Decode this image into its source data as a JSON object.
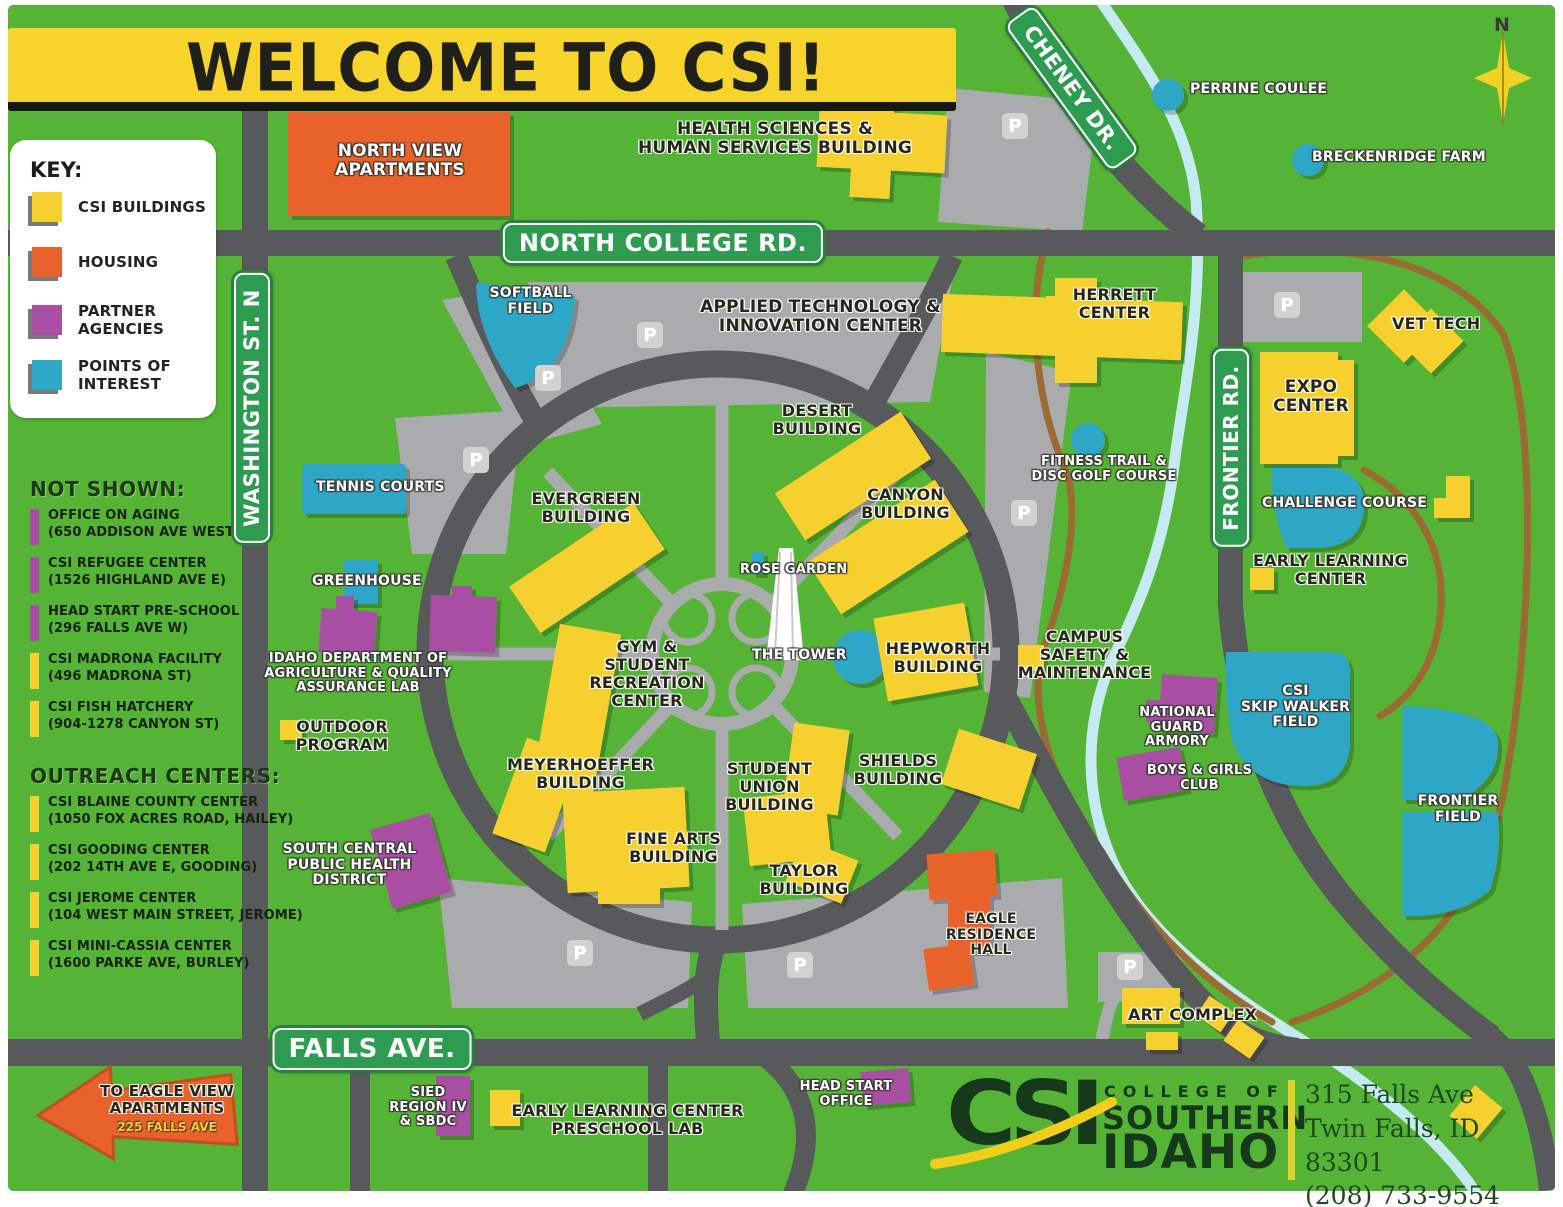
{
  "title": "WELCOME TO CSI!",
  "compass_n": "N",
  "parking_label": "P",
  "colors": {
    "map_green": "#55B335",
    "road_gray": "#58595B",
    "parking_gray": "#A9ABAD",
    "building_yellow": "#F5D02F",
    "housing_orange": "#E8632C",
    "partner_purple": "#A84FA3",
    "interest_teal": "#2FA7C6",
    "sign_green": "#2D9C50",
    "banner_yellow": "#F7D42C",
    "creek_blue": "#C5EAF2",
    "trail_brown": "#9B6B33"
  },
  "key": {
    "heading": "KEY:",
    "items": [
      {
        "label": "CSI BUILDINGS",
        "color": "#F5D02F"
      },
      {
        "label": "HOUSING",
        "color": "#E8632C"
      },
      {
        "label": "PARTNER AGENCIES",
        "color": "#A84FA3"
      },
      {
        "label": "POINTS OF INTEREST",
        "color": "#2FA7C6"
      }
    ]
  },
  "not_shown": {
    "heading": "NOT SHOWN:",
    "items": [
      {
        "name": "OFFICE ON AGING",
        "address": "(650 ADDISON AVE WEST)",
        "color": "#A84FA3"
      },
      {
        "name": "CSI REFUGEE CENTER",
        "address": "(1526 HIGHLAND AVE E)",
        "color": "#A84FA3"
      },
      {
        "name": "HEAD START PRE-SCHOOL",
        "address": "(296 FALLS AVE W)",
        "color": "#A84FA3"
      },
      {
        "name": "CSI MADRONA FACILITY",
        "address": "(496 MADRONA ST)",
        "color": "#F5D02F"
      },
      {
        "name": "CSI FISH HATCHERY",
        "address": "(904-1278 CANYON ST)",
        "color": "#F5D02F"
      }
    ]
  },
  "outreach": {
    "heading": "OUTREACH CENTERS:",
    "items": [
      {
        "name": "CSI BLAINE COUNTY CENTER",
        "address": "(1050 FOX ACRES ROAD, HAILEY)",
        "color": "#F5D02F"
      },
      {
        "name": "CSI GOODING CENTER",
        "address": "(202 14TH AVE E, GOODING)",
        "color": "#F5D02F"
      },
      {
        "name": "CSI JEROME CENTER",
        "address": "(104 WEST MAIN STREET, JEROME)",
        "color": "#F5D02F"
      },
      {
        "name": "CSI MINI-CASSIA CENTER",
        "address": "(1600 PARKE AVE, BURLEY)",
        "color": "#F5D02F"
      }
    ]
  },
  "road_signs": {
    "north_college": "NORTH COLLEGE RD.",
    "washington": "WASHINGTON ST. N",
    "cheney": "CHENEY DR.",
    "frontier": "FRONTIER RD.",
    "falls": "FALLS AVE."
  },
  "labels": {
    "north_view": "NORTH VIEW\nAPARTMENTS",
    "health_sciences": "HEALTH SCIENCES &\nHUMAN SERVICES BUILDING",
    "perrine_coulee": "PERRINE COULEE",
    "breckenridge_farm": "BRECKENRIDGE FARM",
    "softball_field": "SOFTBALL\nFIELD",
    "applied_tech": "APPLIED TECHNOLOGY &\nINNOVATION CENTER",
    "herrett_center": "HERRETT\nCENTER",
    "vet_tech": "VET TECH",
    "expo_center": "EXPO\nCENTER",
    "desert_building": "DESERT\nBUILDING",
    "evergreen_building": "EVERGREEN\nBUILDING",
    "canyon_building": "CANYON\nBUILDING",
    "tennis_courts": "TENNIS COURTS",
    "fitness_trail": "FITNESS TRAIL &\nDISC GOLF COURSE",
    "challenge_course": "CHALLENGE COURSE",
    "early_learning_center": "EARLY LEARNING\nCENTER",
    "rose_garden": "ROSE GARDEN",
    "greenhouse": "GREENHOUSE",
    "gym_rec_center": "GYM &\nSTUDENT\nRECREATION\nCENTER",
    "the_tower": "THE TOWER",
    "hepworth_building": "HEPWORTH\nBUILDING",
    "campus_safety": "CAMPUS\nSAFETY &\nMAINTENANCE",
    "idaho_ag_lab": "IDAHO DEPARTMENT OF\nAGRICULTURE & QUALITY\nASSURANCE LAB",
    "skip_walker_field": "CSI\nSKIP WALKER\nFIELD",
    "national_guard_armory": "NATIONAL\nGUARD\nARMORY",
    "outdoor_program": "OUTDOOR\nPROGRAM",
    "boys_girls_club": "BOYS & GIRLS\nCLUB",
    "frontier_field": "FRONTIER\nFIELD",
    "meyerhoeffer_building": "MEYERHOEFFER\nBUILDING",
    "student_union_building": "STUDENT\nUNION\nBUILDING",
    "shields_building": "SHIELDS\nBUILDING",
    "fine_arts_building": "FINE ARTS\nBUILDING",
    "south_central_health": "SOUTH CENTRAL\nPUBLIC HEALTH\nDISTRICT",
    "taylor_building": "TAYLOR\nBUILDING",
    "eagle_residence_hall": "EAGLE\nRESIDENCE\nHALL",
    "art_complex": "ART COMPLEX",
    "sied_region": "SIED\nREGION IV\n& SBDC",
    "preschool_lab": "EARLY LEARNING CENTER\nPRESCHOOL LAB",
    "head_start_office": "HEAD START\nOFFICE"
  },
  "arrow": {
    "text": "TO EAGLE VIEW\nAPARTMENTS",
    "address": "225 FALLS AVE"
  },
  "logo": {
    "acronym": "CSI",
    "college_of": "COLLEGE OF",
    "southern": "SOUTHERN",
    "idaho": "IDAHO",
    "address_line1": "315 Falls Ave",
    "address_line2": "Twin Falls, ID 83301",
    "phone": "(208) 733-9554"
  }
}
